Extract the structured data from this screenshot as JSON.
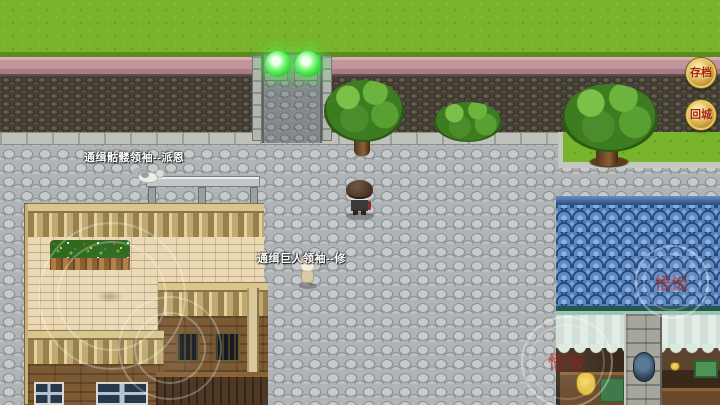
{
  "world": {
    "wanted_labels": [
      "通缉骷髅领袖--派恩",
      "通缉巨人领袖--修"
    ]
  },
  "hud": {
    "save_button_label": "存档",
    "return_city_button_label": "回城",
    "watermark_roof": "悟饭",
    "watermark_bottom": "悟饭"
  },
  "colors": {
    "grass": "#7ab32c",
    "wall_cap_pink": "#c2959c",
    "wall_face": "#46413a",
    "cobblestone": "#b0b4b6",
    "blue_roof": "#4a72aa",
    "terrace_cream": "#ead9b4",
    "wood_brown": "#7c5a34",
    "button_gold": "#d8ae4c",
    "button_text_red": "#a42616",
    "lamp_green": "#3ee43e"
  }
}
